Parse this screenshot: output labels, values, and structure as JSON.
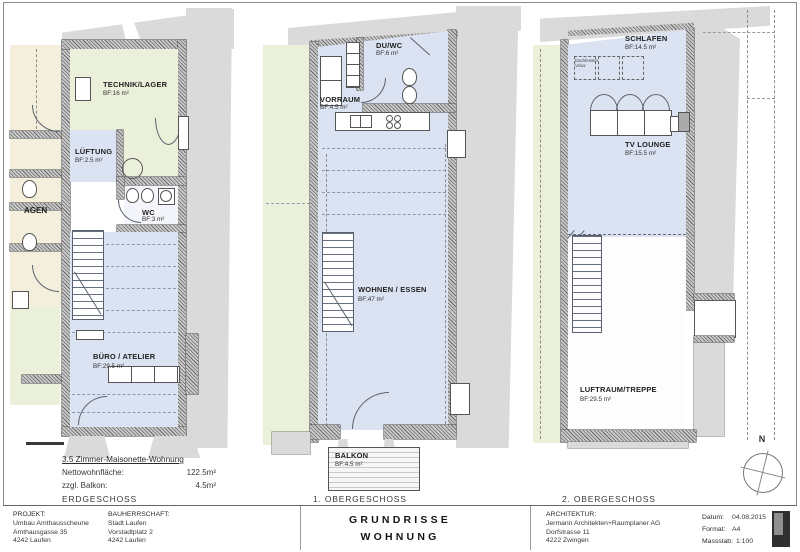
{
  "colors": {
    "room_blue": "#dbe2f1",
    "room_green": "#eaf0d9",
    "room_beige": "#f4efdc",
    "wall_gray": "#c9c9c9",
    "band_gray": "#dadada"
  },
  "plans": [
    {
      "floor_label": "ERDGESCHOSS",
      "adjacent_label": "AGEN",
      "rooms": {
        "technik": {
          "name": "TECHNIK/LAGER",
          "area": "BF:16 m²"
        },
        "lueftung": {
          "name": "LÜFTUNG",
          "area": "BF:2.5 m²"
        },
        "wc": {
          "name": "WC",
          "area": "BF:3 m²"
        },
        "buero": {
          "name": "BÜRO / ATELIER",
          "area": "BF:29.5 m²"
        }
      },
      "summary": {
        "title": "3.5 Zimmer-Maisonette-Wohnung",
        "row1_label": "Nettowohnfläche:",
        "row1_value": "122.5m²",
        "row2_label": "zzgl. Balkon:",
        "row2_value": "4.5m²"
      }
    },
    {
      "floor_label": "1. OBERGESCHOSS",
      "rooms": {
        "vorraum": {
          "name": "VORRAUM",
          "area": "BF:4.5 m²"
        },
        "duwc": {
          "name": "DU/WC",
          "area": "BF:6 m²"
        },
        "wohnen": {
          "name": "WOHNEN / ESSEN",
          "area": "BF:47 m²"
        },
        "balkon": {
          "name": "BALKON",
          "area": "BF:4.5 m²"
        }
      }
    },
    {
      "floor_label": "2. OBERGESCHOSS",
      "rooms": {
        "schlafen": {
          "name": "SCHLAFEN",
          "area": "BF:14.5 m²"
        },
        "tv": {
          "name": "TV LOUNGE",
          "area": "BF:15.5 m²"
        },
        "luftraum": {
          "name": "LUFTRAUM/TREPPE",
          "area": "BF:29.5 m²"
        }
      },
      "annotations": {
        "dachfenster_line1": "Dachfenster",
        "dachfenster_line2": "Velux"
      },
      "north_label": "N"
    }
  ],
  "titleblock": {
    "projekt": {
      "label": "PROJEKT:",
      "lines": [
        "Umbau Amthausscheune",
        "Amthausgasse 35",
        "4242 Laufen"
      ]
    },
    "bauherrschaft": {
      "label": "BAUHERRSCHAFT:",
      "lines": [
        "Stadt Laufen",
        "Vorstadtplatz 2",
        "4242 Laufen"
      ]
    },
    "center": {
      "line1": "GRUNDRISSE",
      "line2": "WOHNUNG"
    },
    "architektur": {
      "label": "ARCHITEKTUR:",
      "lines": [
        "Jermann Architekten+Raumplaner AG",
        "Dorfstrasse 11",
        "4222 Zwingen"
      ]
    },
    "meta": {
      "datum_label": "Datum:",
      "datum_value": "04.08.2015",
      "format_label": "Format:",
      "format_value": "A4",
      "massstab_label": "Massstab:",
      "massstab_value": "1:100"
    }
  }
}
